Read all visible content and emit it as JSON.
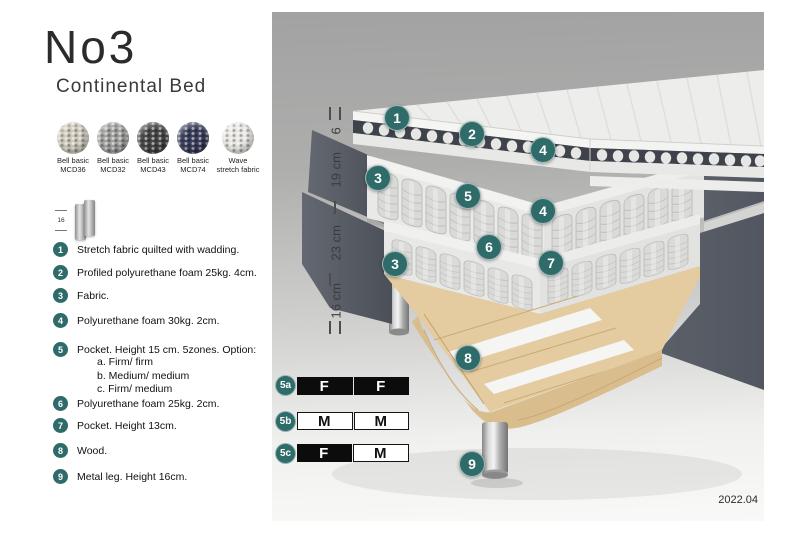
{
  "header": {
    "title": "No3",
    "subtitle": "Continental Bed"
  },
  "swatches": [
    {
      "line1": "Bell basic",
      "line2": "MCD36",
      "color": "#cfc9bc"
    },
    {
      "line1": "Bell basic",
      "line2": "MCD32",
      "color": "#a0a09e"
    },
    {
      "line1": "Bell basic",
      "line2": "MCD43",
      "color": "#474747"
    },
    {
      "line1": "Bell basic",
      "line2": "MCD74",
      "color": "#3a3e5c"
    },
    {
      "line1": "Wave",
      "line2": "stretch fabric",
      "color": "#e9e7e3"
    }
  ],
  "leg_icon": {
    "dimension": "16"
  },
  "materials": [
    {
      "num": "1",
      "text": "Stretch fabric quilted with wadding."
    },
    {
      "num": "2",
      "text": "Profiled polyurethane foam 25kg. 4cm."
    },
    {
      "num": "3",
      "text": "Fabric."
    },
    {
      "num": "4",
      "text": "Polyurethane foam 30kg. 2cm."
    },
    {
      "num": "5",
      "text": "Pocket. Height 15 cm. 5zones. Option:",
      "options": [
        "a. Firm/ firm",
        "b. Medium/ medium",
        "c. Firm/ medium"
      ]
    },
    {
      "num": "6",
      "text": "Polyurethane foam 25kg. 2cm."
    },
    {
      "num": "7",
      "text": "Pocket. Height 13cm."
    },
    {
      "num": "8",
      "text": "Wood."
    },
    {
      "num": "9",
      "text": "Metal leg. Height 16cm."
    }
  ],
  "diagram": {
    "accent_color": "#2e6b69",
    "dimensions": [
      {
        "label": "6"
      },
      {
        "label": "19 cm"
      },
      {
        "label": "23 cm"
      },
      {
        "label": "16 cm"
      }
    ],
    "callouts": [
      {
        "label": "1"
      },
      {
        "label": "2"
      },
      {
        "label": "4"
      },
      {
        "label": "3"
      },
      {
        "label": "5"
      },
      {
        "label": "4"
      },
      {
        "label": "6"
      },
      {
        "label": "7"
      },
      {
        "label": "3"
      },
      {
        "label": "8"
      },
      {
        "label": "9"
      }
    ]
  },
  "firmness": [
    {
      "id": "5a",
      "cells": [
        {
          "label": "F",
          "variant": "dark"
        },
        {
          "label": "F",
          "variant": "dark"
        }
      ]
    },
    {
      "id": "5b",
      "cells": [
        {
          "label": "M",
          "variant": "light"
        },
        {
          "label": "M",
          "variant": "light"
        }
      ]
    },
    {
      "id": "5c",
      "cells": [
        {
          "label": "F",
          "variant": "dark"
        },
        {
          "label": "M",
          "variant": "light"
        }
      ]
    }
  ],
  "footer": {
    "version": "2022.04"
  }
}
